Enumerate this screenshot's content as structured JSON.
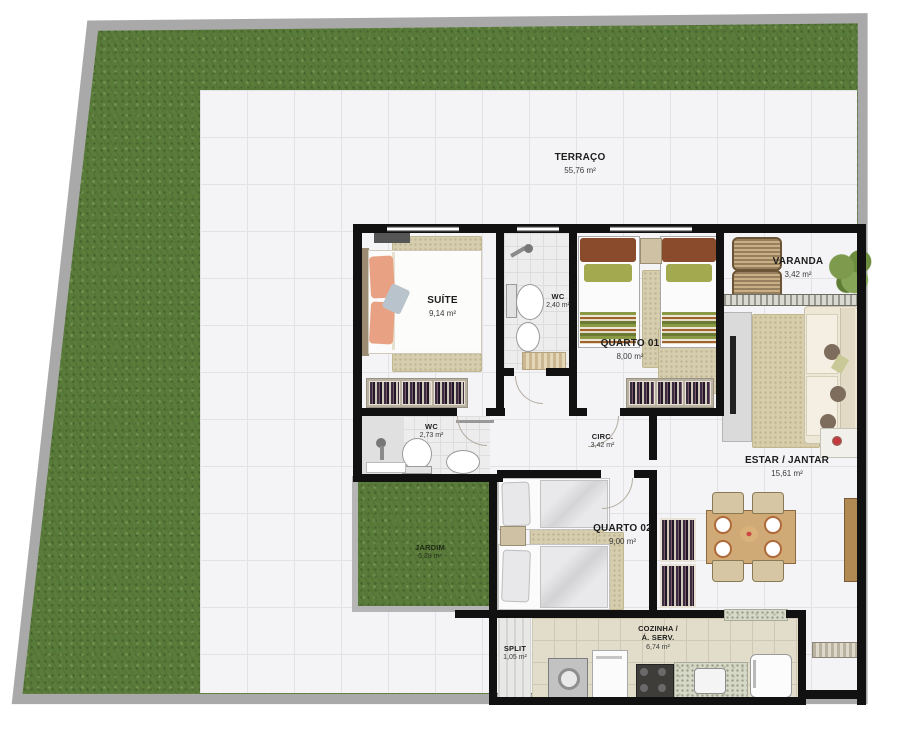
{
  "plan": {
    "rooms": {
      "terraco": {
        "label": "TERRAÇO",
        "area": "55,76 m²"
      },
      "suite": {
        "label": "SUÍTE",
        "area": "9,14 m²"
      },
      "wc_suite": {
        "label": "WC",
        "area": "2,40 m²"
      },
      "quarto01": {
        "label": "QUARTO 01",
        "area": "8,00 m²"
      },
      "varanda": {
        "label": "VARANDA",
        "area": "3,42 m²"
      },
      "estar": {
        "label": "ESTAR / JANTAR",
        "area": "15,61 m²"
      },
      "wc_social": {
        "label": "WC",
        "area": "2,73 m²"
      },
      "circ": {
        "label": "CIRC.",
        "area": "3,42 m²"
      },
      "quarto02": {
        "label": "QUARTO 02",
        "area": "9,00 m²"
      },
      "jardim": {
        "label": "JARDIM",
        "area": "5,28 m²"
      },
      "split": {
        "label": "SPLIT",
        "area": "1,05 m²"
      },
      "cozinha": {
        "label": "COZINHA /",
        "label2": "Á. SERV.",
        "area": "6,74 m²"
      }
    },
    "colors": {
      "grass": "#5a7c3a",
      "lot_wall": "#a9a9a9",
      "wall": "#111111",
      "terrace_tile": "#f4f4f6",
      "kitchen_tile": "#e2ddca",
      "wood": "#c8a877",
      "sofa": "#ece5d2",
      "rug": "#d6cdae",
      "accent_pillow": "#e9a184"
    }
  }
}
